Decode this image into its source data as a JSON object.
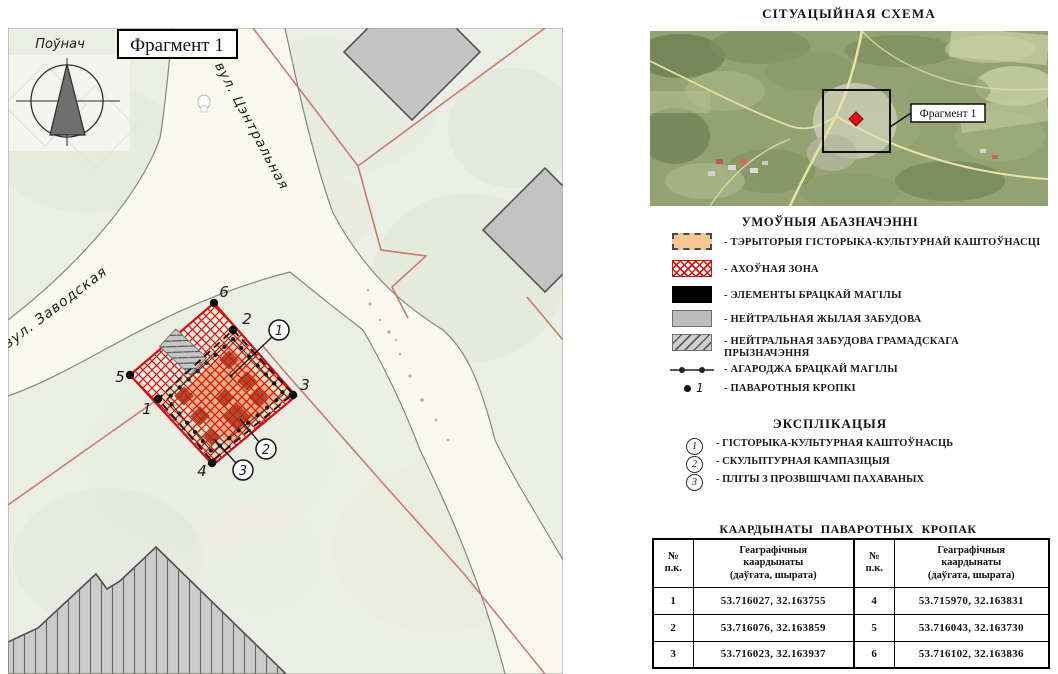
{
  "map": {
    "compass_label": "Поўнач",
    "fragment_label": "Фрагмент 1",
    "street_central": "вул. Цэнтральная",
    "street_zavodskaya": "вул. Заводская",
    "point_labels": [
      "1",
      "2",
      "3",
      "4",
      "5",
      "6"
    ],
    "callout_labels": [
      "1",
      "2",
      "3"
    ]
  },
  "situation": {
    "title": "СІТУАЦЫЙНАЯ СХЕМА",
    "fragment_label": "Фрагмент 1"
  },
  "legend": {
    "title": "УМОЎНЫЯ АБАЗНАЧЭННІ",
    "items": [
      {
        "symbol": "orange-dashed-area",
        "label": "- ТЭРЫТОРЫЯ ГІСТОРЫКА-КУЛЬТУРНАЙ КАШТОЎНАСЦІ"
      },
      {
        "symbol": "red-crosshatch-area",
        "label": "- АХОЎНАЯ ЗОНА"
      },
      {
        "symbol": "black-area",
        "label": "- ЭЛЕМЕНТЫ БРАЦКАЙ МАГІЛЫ"
      },
      {
        "symbol": "gray-area",
        "label": "- НЕЙТРАЛЬНАЯ ЖЫЛАЯ ЗАБУДОВА"
      },
      {
        "symbol": "gray-hatched-area",
        "label": "- НЕЙТРАЛЬНАЯ ЗАБУДОВА ГРАМАДСКАГА ПРЫЗНАЧЭННЯ"
      },
      {
        "symbol": "fence-line",
        "label": "- АГАРОДЖА БРАЦКАЙ МАГІЛЫ"
      },
      {
        "symbol": "point-dot",
        "symbol_number": "1",
        "label": "- ПАВАРОТНЫЯ КРОПКІ"
      }
    ]
  },
  "explication": {
    "title": "ЭКСПЛІКАЦЫЯ",
    "items": [
      {
        "num": "1",
        "label": "- ГІСТОРЫКА-КУЛЬТУРНАЯ КАШТОЎНАСЦЬ"
      },
      {
        "num": "2",
        "label": "- СКУЛЬПТУРНАЯ КАМПАЗІЦЫЯ"
      },
      {
        "num": "3",
        "label": "- ПЛІТЫ З ПРОЗВІШЧАМІ ПАХАВАНЫХ"
      }
    ]
  },
  "coords_table": {
    "title": "КААРДЫНАТЫ  ПАВАРОТНЫХ  КРОПАК",
    "num_header": "№\nп.к.",
    "geo_header": "Геаграфічныя\nкаардынаты\n(даўгата, шырата)",
    "rows": [
      {
        "n1": "1",
        "c1": "53.716027, 32.163755",
        "n2": "4",
        "c2": "53.715970, 32.163831"
      },
      {
        "n1": "2",
        "c1": "53.716076, 32.163859",
        "n2": "5",
        "c2": "53.716043, 32.163730"
      },
      {
        "n1": "3",
        "c1": "53.716023, 32.163937",
        "n2": "6",
        "c2": "53.716102, 32.163836"
      }
    ]
  },
  "colors": {
    "heritage_territory_fill": "#f2c491",
    "protection_zone_red": "#d40f0f",
    "grave_elements_black": "#000000",
    "neutral_building_gray": "#c3c3c3",
    "boundary_pink": "#c97b72",
    "road_fill": "#f9f8ef",
    "map_background": "#eaeee3"
  }
}
